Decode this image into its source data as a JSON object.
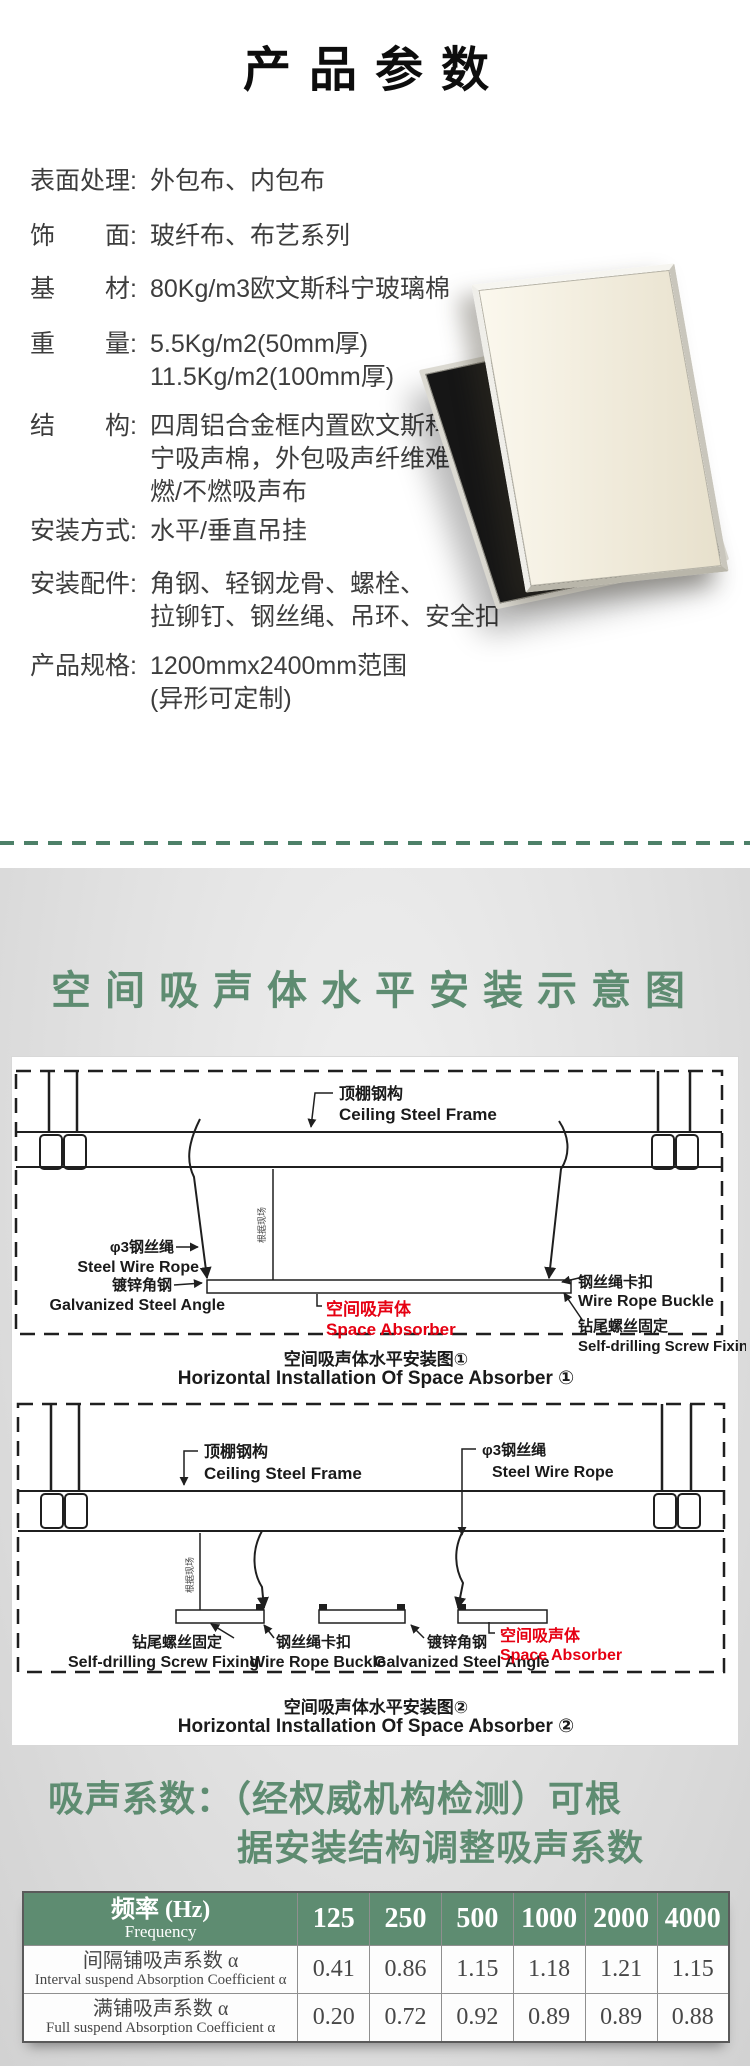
{
  "colors": {
    "accent_green": "#5e8c71",
    "dash_green": "#4d8068",
    "label_red": "#e60012",
    "table_header_bg": "#5e8c71"
  },
  "header": {
    "title": "产品参数"
  },
  "specs": [
    {
      "label": "表面处理:",
      "lines": [
        "外包布、内包布"
      ]
    },
    {
      "label": "饰　　面:",
      "lines": [
        "玻纤布、布艺系列"
      ]
    },
    {
      "label": "基　　材:",
      "lines": [
        "80Kg/m3欧文斯科宁玻璃棉"
      ]
    },
    {
      "label": "重　　量:",
      "lines": [
        "5.5Kg/m2(50mm厚)",
        "11.5Kg/m2(100mm厚)"
      ]
    },
    {
      "label": "结　　构:",
      "lines": [
        "四周铝合金框内置欧文斯科",
        "宁吸声棉，外包吸声纤维难",
        "燃/不燃吸声布"
      ]
    },
    {
      "label": "安装方式:",
      "lines": [
        "水平/垂直吊挂"
      ]
    },
    {
      "label": "安装配件:",
      "lines": [
        "角钢、轻钢龙骨、螺栓、",
        "拉铆钉、钢丝绳、吊环、安全扣"
      ]
    },
    {
      "label": "产品规格:",
      "lines": [
        "1200mmx2400mm范围",
        "(异形可定制)"
      ]
    }
  ],
  "section2": {
    "title": "空间吸声体水平安装示意图"
  },
  "d1": {
    "labels": {
      "ceiling_zh": "顶棚钢构",
      "ceiling_en": "Ceiling Steel Frame",
      "wire_zh": "φ3钢丝绳",
      "wire_en": "Steel Wire Rope",
      "angle_zh": "镀锌角钢",
      "angle_en": "Galvanized Steel Angle",
      "absorber_zh": "空间吸声体",
      "absorber_en": "Space Absorber",
      "buckle_zh": "钢丝绳卡扣",
      "buckle_en": "Wire Rope Buckle",
      "screw_zh": "钻尾螺丝固定",
      "screw_en": "Self-drilling Screw Fixing",
      "site_note": "根据现场"
    },
    "caption_zh": "空间吸声体水平安装图①",
    "caption_en": "Horizontal Installation Of Space Absorber ①"
  },
  "d2": {
    "labels": {
      "ceiling_zh": "顶棚钢构",
      "ceiling_en": "Ceiling Steel Frame",
      "wire_zh": "φ3钢丝绳",
      "wire_en": "Steel Wire Rope",
      "angle_zh": "镀锌角钢",
      "angle_en": "Galvanized Steel Angle",
      "absorber_zh": "空间吸声体",
      "absorber_en": "Space Absorber",
      "buckle_zh": "钢丝绳卡扣",
      "buckle_en": "Wire Rope Buckle",
      "screw_zh": "钻尾螺丝固定",
      "screw_en": "Self-drilling Screw Fixing",
      "site_note": "根据现场"
    },
    "caption_zh": "空间吸声体水平安装图②",
    "caption_en": "Horizontal Installation Of Space Absorber ②"
  },
  "note": {
    "line1": "吸声系数：（经权威机构检测）可根",
    "line2": "据安装结构调整吸声系数"
  },
  "table": {
    "header_zh": "频率 (Hz)",
    "header_en": "Frequency",
    "freqs": [
      "125",
      "250",
      "500",
      "1000",
      "2000",
      "4000"
    ],
    "rows": [
      {
        "label_zh": "间隔铺吸声系数 α",
        "label_en": "Interval suspend Absorption Coefficient α",
        "values": [
          "0.41",
          "0.86",
          "1.15",
          "1.18",
          "1.21",
          "1.15"
        ]
      },
      {
        "label_zh": "满铺吸声系数 α",
        "label_en": "Full suspend Absorption Coefficient α",
        "values": [
          "0.20",
          "0.72",
          "0.92",
          "0.89",
          "0.89",
          "0.88"
        ]
      }
    ]
  }
}
